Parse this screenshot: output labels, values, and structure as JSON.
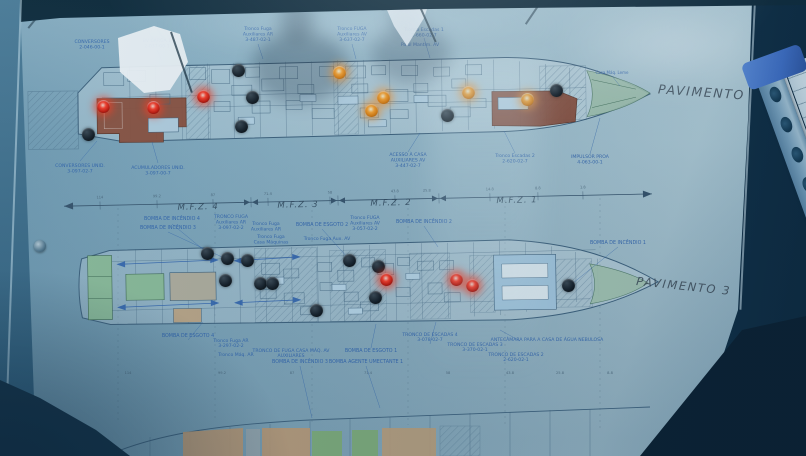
{
  "titles": {
    "deck2": "PAVIMENTO 2",
    "deck3": "PAVIMENTO 3"
  },
  "zones": {
    "items": [
      {
        "label": "M.F.Z. 4",
        "x": 198
      },
      {
        "label": "M.F.Z. 3",
        "x": 298
      },
      {
        "label": "M.F.Z. 2",
        "x": 391
      },
      {
        "label": "M.F.Z. 1",
        "x": 517
      }
    ],
    "frame_numbers_top": [
      {
        "v": "114",
        "x": 100
      },
      {
        "v": "99.2",
        "x": 157
      },
      {
        "v": "87",
        "x": 213
      },
      {
        "v": "71.4",
        "x": 268
      },
      {
        "v": "58",
        "x": 330
      },
      {
        "v": "43.8",
        "x": 395
      },
      {
        "v": "25.8",
        "x": 427
      },
      {
        "v": "14.8",
        "x": 490
      },
      {
        "v": "8.8",
        "x": 538
      },
      {
        "v": "1.8",
        "x": 583
      }
    ],
    "frame_numbers_bottom": [
      {
        "v": "114",
        "x": 128
      },
      {
        "v": "99.2",
        "x": 222
      },
      {
        "v": "87",
        "x": 292
      },
      {
        "v": "71.4",
        "x": 368
      },
      {
        "v": "58",
        "x": 448
      },
      {
        "v": "43.8",
        "x": 510
      },
      {
        "v": "25.8",
        "x": 560
      },
      {
        "v": "8.8",
        "x": 610
      }
    ]
  },
  "plan_labels": [
    {
      "t": "CONVERSORES",
      "x": 92,
      "y": 43
    },
    {
      "t": "2-046-00-1",
      "x": 92,
      "y": 48.5
    },
    {
      "t": "BV CARGA 1",
      "x": 157,
      "y": 42
    },
    {
      "t": "2-037-00-1",
      "x": 157,
      "y": 47.5
    },
    {
      "t": "Tronco Fuga",
      "x": 258,
      "y": 30
    },
    {
      "t": "Auxiliares AR",
      "x": 258,
      "y": 35.5
    },
    {
      "t": "3-487-02-1",
      "x": 258,
      "y": 41
    },
    {
      "t": "Tronco FUGA",
      "x": 352,
      "y": 30
    },
    {
      "t": "Auxiliares AV",
      "x": 352,
      "y": 35.5
    },
    {
      "t": "3-637-02-7",
      "x": 352,
      "y": 41
    },
    {
      "t": "Tronco Escadas 1",
      "x": 424,
      "y": 31
    },
    {
      "t": "2-660-02-7",
      "x": 424,
      "y": 36.5
    },
    {
      "t": "Paiol Mantim. AV",
      "x": 420,
      "y": 46
    },
    {
      "t": "Casa Máq. Leme",
      "x": 612,
      "y": 74,
      "s": 4
    },
    {
      "t": "Tronco Escadas 2",
      "x": 515,
      "y": 157
    },
    {
      "t": "2-620-02-7",
      "x": 515,
      "y": 162.5
    },
    {
      "t": "ACESSO À CASA",
      "x": 408,
      "y": 156
    },
    {
      "t": "AUXILIARES AV",
      "x": 408,
      "y": 161.5
    },
    {
      "t": "3-447-02-7",
      "x": 408,
      "y": 167
    },
    {
      "t": "IMPULSOR PROA",
      "x": 590,
      "y": 158
    },
    {
      "t": "4-063-00-1",
      "x": 590,
      "y": 163.5
    },
    {
      "t": "CONVERSORES UNID.",
      "x": 80,
      "y": 167
    },
    {
      "t": "3-097-02-7",
      "x": 80,
      "y": 172.5
    },
    {
      "t": "ACUMULADORES UNID.",
      "x": 158,
      "y": 169
    },
    {
      "t": "3-097-00-7",
      "x": 158,
      "y": 174.5
    },
    {
      "t": "BOMBA DE INCÊNDIO 4",
      "x": 172,
      "y": 220,
      "s": 4.8
    },
    {
      "t": "BOMBA DE INCÊNDIO 3",
      "x": 168,
      "y": 229,
      "s": 4.8
    },
    {
      "t": "TRONCO FUGA",
      "x": 231,
      "y": 218
    },
    {
      "t": "Auxiliares AR",
      "x": 231,
      "y": 223.5
    },
    {
      "t": "3-097-02-2",
      "x": 231,
      "y": 229
    },
    {
      "t": "Tronco Fuga",
      "x": 266,
      "y": 225
    },
    {
      "t": "Auxiliares AR",
      "x": 266,
      "y": 230.5
    },
    {
      "t": "Tronco Fuga",
      "x": 271,
      "y": 238
    },
    {
      "t": "Casa Máquinas",
      "x": 271,
      "y": 243.5
    },
    {
      "t": "BOMBA DE ESGOTO 2",
      "x": 322,
      "y": 226,
      "s": 4.8
    },
    {
      "t": "Tronco FUGA",
      "x": 365,
      "y": 219
    },
    {
      "t": "Auxiliares AV",
      "x": 365,
      "y": 224.5
    },
    {
      "t": "3-057-02-2",
      "x": 365,
      "y": 230
    },
    {
      "t": "Tronco Fuga  Aux. AV",
      "x": 327,
      "y": 240
    },
    {
      "t": "BOMBA DE INCÊNDIO 2",
      "x": 424,
      "y": 223,
      "s": 4.8
    },
    {
      "t": "BOMBA DE INCÊNDIO 1",
      "x": 618,
      "y": 244,
      "s": 4.8
    },
    {
      "t": "BOMBA DE ESGOTO 4",
      "x": 188,
      "y": 337,
      "s": 4.8
    },
    {
      "t": "Tronco Fuga AR",
      "x": 231,
      "y": 342
    },
    {
      "t": "3-297-02-2",
      "x": 231,
      "y": 347
    },
    {
      "t": "Tronco Máq. AR",
      "x": 236,
      "y": 356
    },
    {
      "t": "TRONCO DE FUGA CASA MÁQ. AV",
      "x": 291,
      "y": 352
    },
    {
      "t": "AUXILIARES",
      "x": 291,
      "y": 357
    },
    {
      "t": "BOMBA DE INCÊNDIO 3",
      "x": 300,
      "y": 363,
      "s": 4.8
    },
    {
      "t": "BOMBA DE ESGOTO 1",
      "x": 371,
      "y": 352,
      "s": 4.8
    },
    {
      "t": "BOMBA AGENTE UMECTANTE 1",
      "x": 366,
      "y": 363,
      "s": 4.8
    },
    {
      "t": "TRONCO DE ESCADAS 4",
      "x": 430,
      "y": 336
    },
    {
      "t": "3-078-02-7",
      "x": 430,
      "y": 341
    },
    {
      "t": "TRONCO DE ESCADAS 3",
      "x": 475,
      "y": 346
    },
    {
      "t": "3-370-02-1",
      "x": 475,
      "y": 351
    },
    {
      "t": "TRONCO DE ESCADAS 2",
      "x": 516,
      "y": 356
    },
    {
      "t": "2-620-02-1",
      "x": 516,
      "y": 361
    },
    {
      "t": "ANTECÂMARA PARA A CASA DE ÁGUA NEBULOSA",
      "x": 547,
      "y": 341
    }
  ],
  "leds": {
    "deck2": [
      {
        "x": 103,
        "y": 106,
        "state": "red"
      },
      {
        "x": 153,
        "y": 107,
        "state": "red"
      },
      {
        "x": 203,
        "y": 96,
        "state": "red"
      },
      {
        "x": 339,
        "y": 72,
        "state": "amber"
      },
      {
        "x": 383,
        "y": 97,
        "state": "amber"
      },
      {
        "x": 371,
        "y": 110,
        "state": "amber"
      },
      {
        "x": 468,
        "y": 92,
        "state": "amber"
      },
      {
        "x": 527,
        "y": 99,
        "state": "amber"
      },
      {
        "x": 238,
        "y": 70,
        "state": "off"
      },
      {
        "x": 252,
        "y": 97,
        "state": "off"
      },
      {
        "x": 241,
        "y": 126,
        "state": "off"
      },
      {
        "x": 88,
        "y": 134,
        "state": "off"
      },
      {
        "x": 556,
        "y": 90,
        "state": "off"
      },
      {
        "x": 447,
        "y": 115,
        "state": "off"
      }
    ],
    "deck3": [
      {
        "x": 207,
        "y": 253,
        "state": "off"
      },
      {
        "x": 227,
        "y": 258,
        "state": "off"
      },
      {
        "x": 247,
        "y": 260,
        "state": "off"
      },
      {
        "x": 225,
        "y": 280,
        "state": "off"
      },
      {
        "x": 260,
        "y": 283,
        "state": "off"
      },
      {
        "x": 272,
        "y": 283,
        "state": "off"
      },
      {
        "x": 349,
        "y": 260,
        "state": "off"
      },
      {
        "x": 378,
        "y": 266,
        "state": "off"
      },
      {
        "x": 375,
        "y": 297,
        "state": "off"
      },
      {
        "x": 316,
        "y": 310,
        "state": "off"
      },
      {
        "x": 568,
        "y": 285,
        "state": "off"
      },
      {
        "x": 386,
        "y": 279,
        "state": "red"
      },
      {
        "x": 456,
        "y": 279,
        "state": "red"
      },
      {
        "x": 472,
        "y": 285,
        "state": "red"
      }
    ]
  },
  "colors": {
    "led_red": "#ff3b26",
    "led_amber": "#ffa126",
    "label_blue": "#2b5fae",
    "plan_line": "#3e617c",
    "compartment_brown": "#8f4f3a",
    "compartment_green": "#8fbf9a",
    "compartment_blue": "#a9cde4",
    "bow_green": "#a8c9b2",
    "binder_paper": "#d9e9f1",
    "binder_spine": "#7da6c2",
    "binder_clip": "#3f6fc8"
  }
}
